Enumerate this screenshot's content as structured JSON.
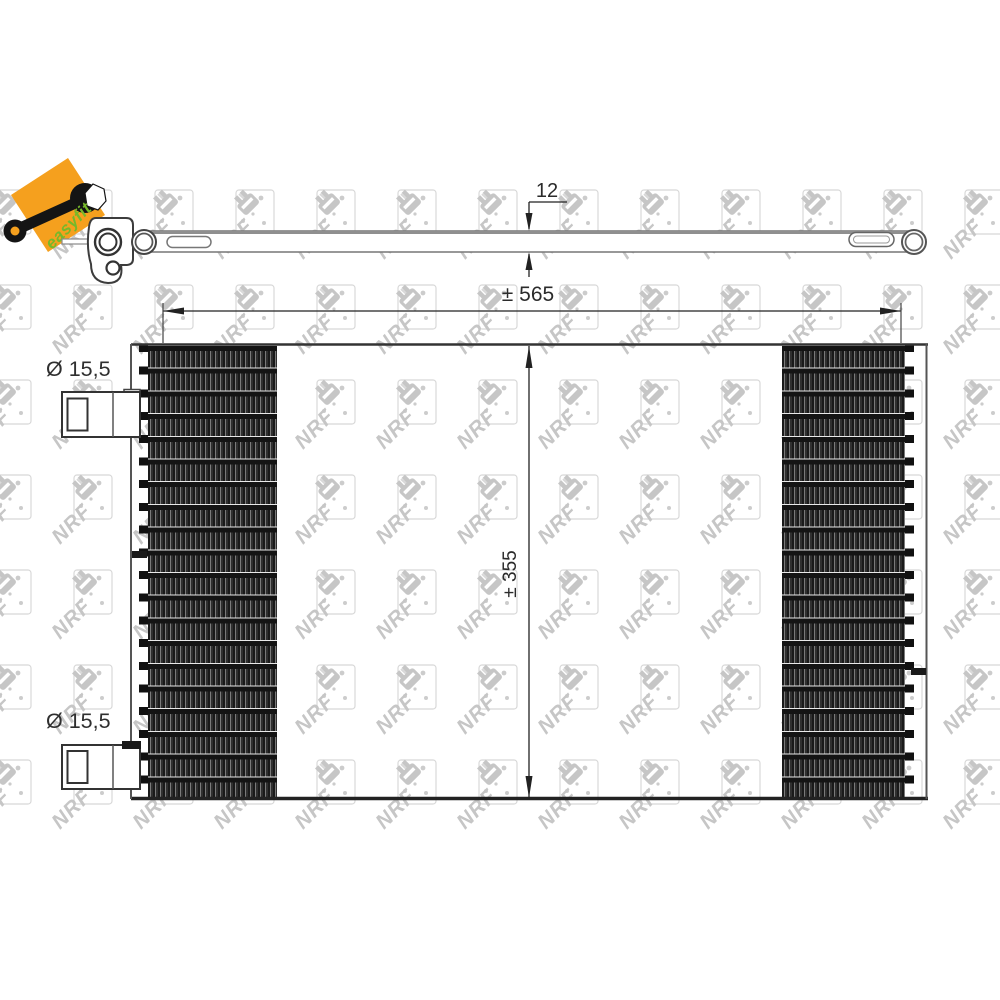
{
  "product_view": "condenser-technical-drawing",
  "logo": {
    "text": "easyfit",
    "square_color": "#F5A01E",
    "text_color": "#76B82A",
    "wrench_color": "#141414"
  },
  "watermark": {
    "text": "NRF",
    "color": "#c6c6c6",
    "box_color": "#d8d8d8",
    "dot_color": "#cccccc"
  },
  "dimensions": {
    "depth": {
      "label": "12"
    },
    "width": {
      "label": "± 565"
    },
    "height": {
      "label": "± 355"
    },
    "port_top": {
      "label": "Ø 15,5"
    },
    "port_bottom": {
      "label": "Ø 15,5"
    }
  },
  "colors": {
    "line": "#333333",
    "dim_line": "#222222",
    "edge_dark": "#222222",
    "side_gray": "#555555"
  }
}
